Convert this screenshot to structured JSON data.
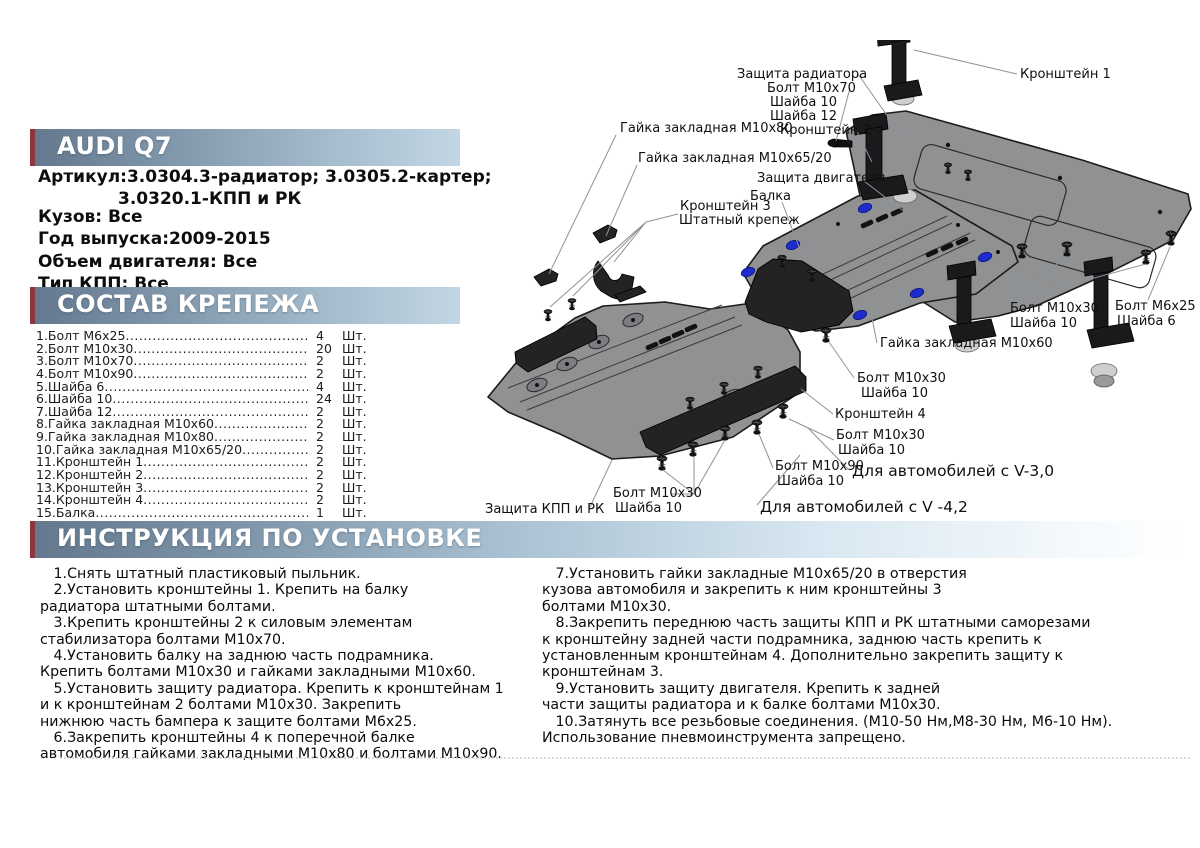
{
  "header": {
    "brand": "AUDI Q7",
    "article_line1": "Артикул:3.0304.3-радиатор; 3.0305.2-картер;",
    "article_line2": "3.0320.1-КПП и РК",
    "specs": [
      "Кузов: Все",
      "Год выпуска:2009-2015",
      "Объем двигателя: Все",
      "Тип КПП: Все"
    ]
  },
  "parts": {
    "title": "СОСТАВ КРЕПЕЖА",
    "unit": "Шт.",
    "items": [
      {
        "name": "1.Болт М6х25",
        "qty": "4"
      },
      {
        "name": "2.Болт М10х30",
        "qty": "20"
      },
      {
        "name": "3.Болт М10х70",
        "qty": "2"
      },
      {
        "name": "4.Болт М10х90",
        "qty": "2"
      },
      {
        "name": "5.Шайба 6",
        "qty": "4"
      },
      {
        "name": "6.Шайба 10",
        "qty": "24"
      },
      {
        "name": "7.Шайба 12",
        "qty": "2"
      },
      {
        "name": "8.Гайка закладная М10х60",
        "qty": "2"
      },
      {
        "name": "9.Гайка закладная М10х80",
        "qty": "2"
      },
      {
        "name": "10.Гайка закладная М10х65/20",
        "qty": "2"
      },
      {
        "name": "11.Кронштейн 1",
        "qty": "2"
      },
      {
        "name": "12.Кронштейн 2",
        "qty": "2"
      },
      {
        "name": "13.Кронштейн 3",
        "qty": "2"
      },
      {
        "name": "14.Кронштейн 4",
        "qty": "2"
      },
      {
        "name": "15.Балка",
        "qty": "1"
      }
    ]
  },
  "instructions": {
    "title": "ИНСТРУКЦИЯ ПО УСТАНОВКЕ",
    "left": [
      "   1.Снять штатный пластиковый пыльник.",
      "   2.Установить кронштейны 1. Крепить на балку\nрадиатора штатными болтами.",
      "   3.Крепить кронштейны 2 к силовым элементам\nстабилизатора болтами М10х70.",
      "   4.Установить балку на заднюю часть подрамника.\nКрепить болтами М10х30 и гайками закладными М10х60.",
      "   5.Установить защиту радиатора. Крепить к кронштейнам 1\nи к кронштейнам 2 болтами М10х30. Закрепить\nнижнюю часть бампера к защите болтами М6х25.",
      "   6.Закрепить кронштейны 4 к поперечной балке\nавтомобиля гайками закладными М10х80 и болтами М10х90."
    ],
    "right": [
      "   7.Установить гайки закладные М10х65/20 в отверстия\nкузова автомобиля и закрепить к ним кронштейны 3\nболтами М10х30.",
      "   8.Закрепить переднюю часть защиты КПП и РК штатными саморезами\nк кронштейну задней части подрамника, заднюю часть крепить к\nустановленным кронштейнам 4. Дополнительно закрепить защиту к\nкронштейнам 3.",
      "   9.Установить защиту двигателя. Крепить к задней\nчасти защиты радиатора и к балке болтами М10х30.",
      "   10.Затянуть все резьбовые соединения. (М10-50 Нм,М8-30 Нм, М6-10 Нм).\nИспользование пневмоинструмента запрещено."
    ]
  },
  "diagram": {
    "labels": [
      {
        "text": "Защита радиатора",
        "x": 737,
        "y": 78,
        "size": 13
      },
      {
        "text": "Болт М10х70",
        "x": 767,
        "y": 92,
        "size": 13
      },
      {
        "text": "Шайба 10",
        "x": 770,
        "y": 106,
        "size": 13
      },
      {
        "text": "Шайба 12",
        "x": 770,
        "y": 120,
        "size": 13
      },
      {
        "text": "Кронштейн 2",
        "x": 780,
        "y": 134,
        "size": 13
      },
      {
        "text": "Кронштейн 1",
        "x": 1020,
        "y": 78,
        "size": 13
      },
      {
        "text": "Гайка закладная М10х80",
        "x": 620,
        "y": 132,
        "size": 13
      },
      {
        "text": "Гайка закладная М10х65/20",
        "x": 638,
        "y": 162,
        "size": 13
      },
      {
        "text": "Защита двигателя",
        "x": 757,
        "y": 182,
        "size": 13
      },
      {
        "text": "Балка",
        "x": 750,
        "y": 200,
        "size": 13
      },
      {
        "text": "Кронштейн 3",
        "x": 680,
        "y": 210,
        "size": 13
      },
      {
        "text": "Штатный крепеж",
        "x": 679,
        "y": 224,
        "size": 13
      },
      {
        "text": "Болт М10х30",
        "x": 1010,
        "y": 312,
        "size": 13
      },
      {
        "text": "Шайба 10",
        "x": 1010,
        "y": 327,
        "size": 13
      },
      {
        "text": "Болт М6х25",
        "x": 1115,
        "y": 310,
        "size": 13
      },
      {
        "text": "Шайба 6",
        "x": 1117,
        "y": 325,
        "size": 13
      },
      {
        "text": "Гайка закладная М10х60",
        "x": 880,
        "y": 347,
        "size": 13
      },
      {
        "text": "Болт М10х30",
        "x": 857,
        "y": 382,
        "size": 13
      },
      {
        "text": "Шайба 10",
        "x": 861,
        "y": 397,
        "size": 13
      },
      {
        "text": "Кронштейн 4",
        "x": 835,
        "y": 418,
        "size": 13
      },
      {
        "text": "Болт М10х30",
        "x": 836,
        "y": 439,
        "size": 13
      },
      {
        "text": "Шайба 10",
        "x": 838,
        "y": 454,
        "size": 13
      },
      {
        "text": "Болт М10х90",
        "x": 775,
        "y": 470,
        "size": 13
      },
      {
        "text": "Шайба 10",
        "x": 777,
        "y": 485,
        "size": 13
      },
      {
        "text": "Для автомобилей с V-3,0",
        "x": 852,
        "y": 476,
        "size": 15.5
      },
      {
        "text": "Для автомобилей с V -4,2",
        "x": 760,
        "y": 512,
        "size": 15.5
      },
      {
        "text": "Болт М10х30",
        "x": 613,
        "y": 497,
        "size": 13
      },
      {
        "text": "Шайба 10",
        "x": 615,
        "y": 512,
        "size": 13
      },
      {
        "text": "Защита КПП и РК",
        "x": 485,
        "y": 513,
        "size": 13
      }
    ]
  },
  "colors": {
    "accent_stripe": "#8e353e",
    "bar_gradient_start": "#63788d",
    "bar_gradient_end": "#c3d6e4",
    "plate_gray": "#8f9193",
    "hole_blue": "#1e2ccd",
    "text": "#111111"
  }
}
